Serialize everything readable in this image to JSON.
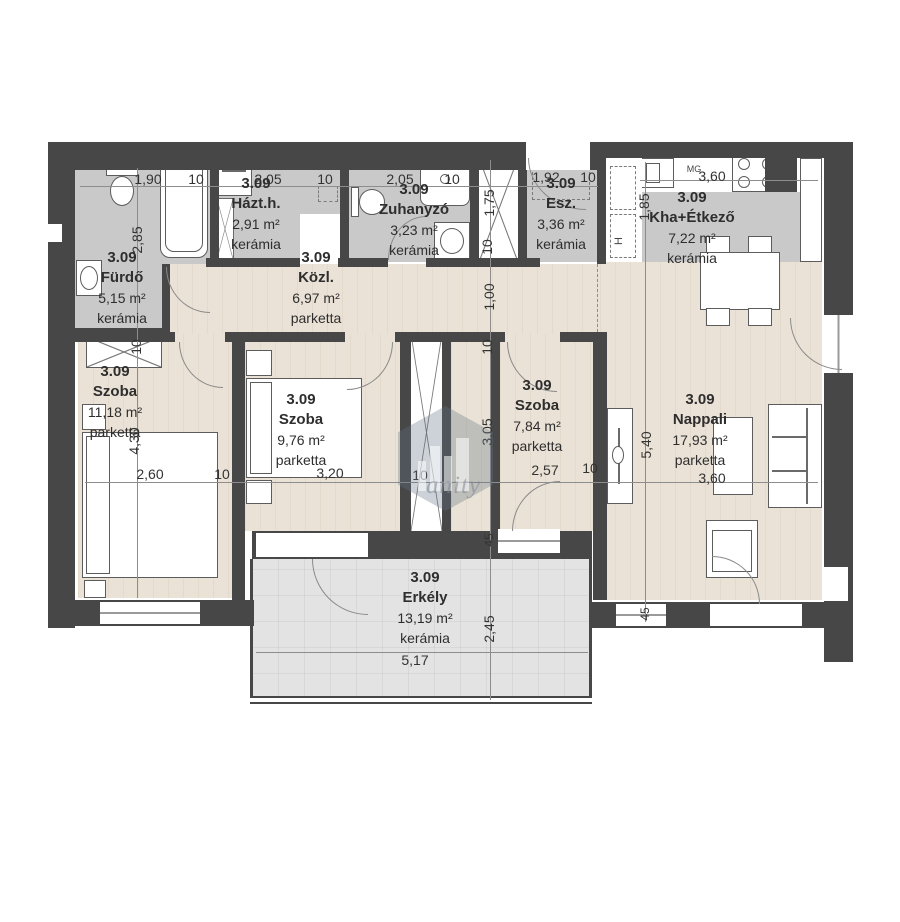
{
  "rooms": {
    "furdo": {
      "id": "3.09",
      "name": "Fürdő",
      "area": "5,15 m²",
      "flooring": "kerámia"
    },
    "hazth": {
      "id": "3.09",
      "name": "Házt.h.",
      "area": "2,91 m²",
      "flooring": "kerámia"
    },
    "zuhanyzo": {
      "id": "3.09",
      "name": "Zuhanyzó",
      "area": "3,23 m²",
      "flooring": "kerámia"
    },
    "esz": {
      "id": "3.09",
      "name": "Esz.",
      "area": "3,36 m²",
      "flooring": "kerámia"
    },
    "konyha": {
      "id": "3.09",
      "name": "Kha+Étkező",
      "area": "7,22 m²",
      "flooring": "kerámia"
    },
    "kozl": {
      "id": "3.09",
      "name": "Közl.",
      "area": "6,97 m²",
      "flooring": "parketta"
    },
    "szoba1": {
      "id": "3.09",
      "name": "Szoba",
      "area": "11,18 m²",
      "flooring": "parketta"
    },
    "szoba2": {
      "id": "3.09",
      "name": "Szoba",
      "area": "9,76 m²",
      "flooring": "parketta"
    },
    "szoba3": {
      "id": "3.09",
      "name": "Szoba",
      "area": "7,84 m²",
      "flooring": "parketta"
    },
    "nappali": {
      "id": "3.09",
      "name": "Nappali",
      "area": "17,93 m²",
      "flooring": "parketta"
    },
    "erkely": {
      "id": "3.09",
      "name": "Erkély",
      "area": "13,19 m²",
      "flooring": "kerámia"
    }
  },
  "dims": {
    "furdo_w": "1,90",
    "hazth_w": "2,05",
    "zuh_w": "2,05",
    "esz_w": "1,92",
    "konyha_w": "3,60",
    "szoba1_w": "2,60",
    "szoba2_w": "3,20",
    "szoba3_w": "2,57",
    "nappali_w": "3,60",
    "erkely_w": "5,17",
    "furdo_h": "2,85",
    "gardrob_h": "1,75",
    "kozl_w": "1,00",
    "konyha_h": "1,85",
    "szoba1_h": "4,30",
    "szoba3_h": "3,05",
    "nappali_h": "5,40",
    "erkely_h": "2,45",
    "wall10": "10",
    "wall45": "45"
  },
  "appliances": {
    "dishwasher": "MG",
    "fridge": "H"
  },
  "watermark": {
    "text": "anity"
  },
  "colors": {
    "wall": "#474747",
    "ceramic": "#c9c9c9",
    "parquet": "#eae2d6",
    "balcony_tile": "#e3e3e3"
  }
}
